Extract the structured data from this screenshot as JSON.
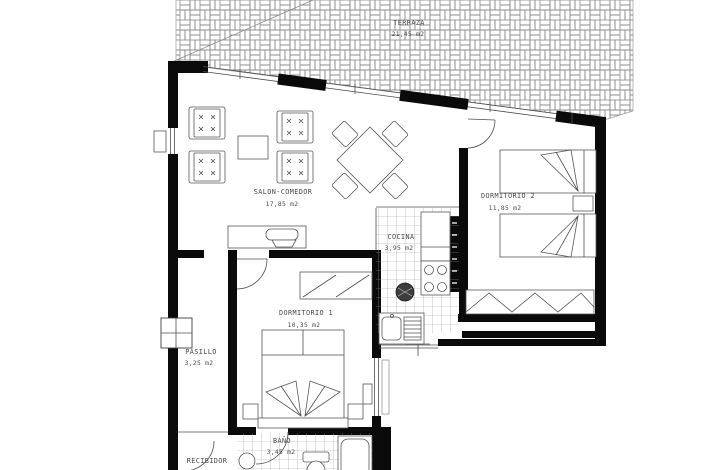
{
  "plan": {
    "colors": {
      "background": "#ffffff",
      "walls": "#0a0a0a",
      "drawing_lines": "#4f4f4f",
      "hatch": "#8a8a8a",
      "label_text": "#4a4a4a"
    },
    "rooms": {
      "terraza": {
        "name": "TERRAZA",
        "area": "21,45 m2"
      },
      "salon": {
        "name": "SALON-COMEDOR",
        "area": "17,85 m2"
      },
      "dormitorio2": {
        "name": "DORMITORIO 2",
        "area": "11,85 m2"
      },
      "cocina": {
        "name": "COCINA",
        "area": "3,95 m2"
      },
      "dormitorio1": {
        "name": "DORMITORIO 1",
        "area": "10,35 m2"
      },
      "pasillo": {
        "name": "PASILLO",
        "area": "3,25 m2"
      },
      "bano": {
        "name": "BAÑO",
        "area": "3,45 m2"
      },
      "recibidor": {
        "name": "RECIBIDOR"
      }
    }
  }
}
